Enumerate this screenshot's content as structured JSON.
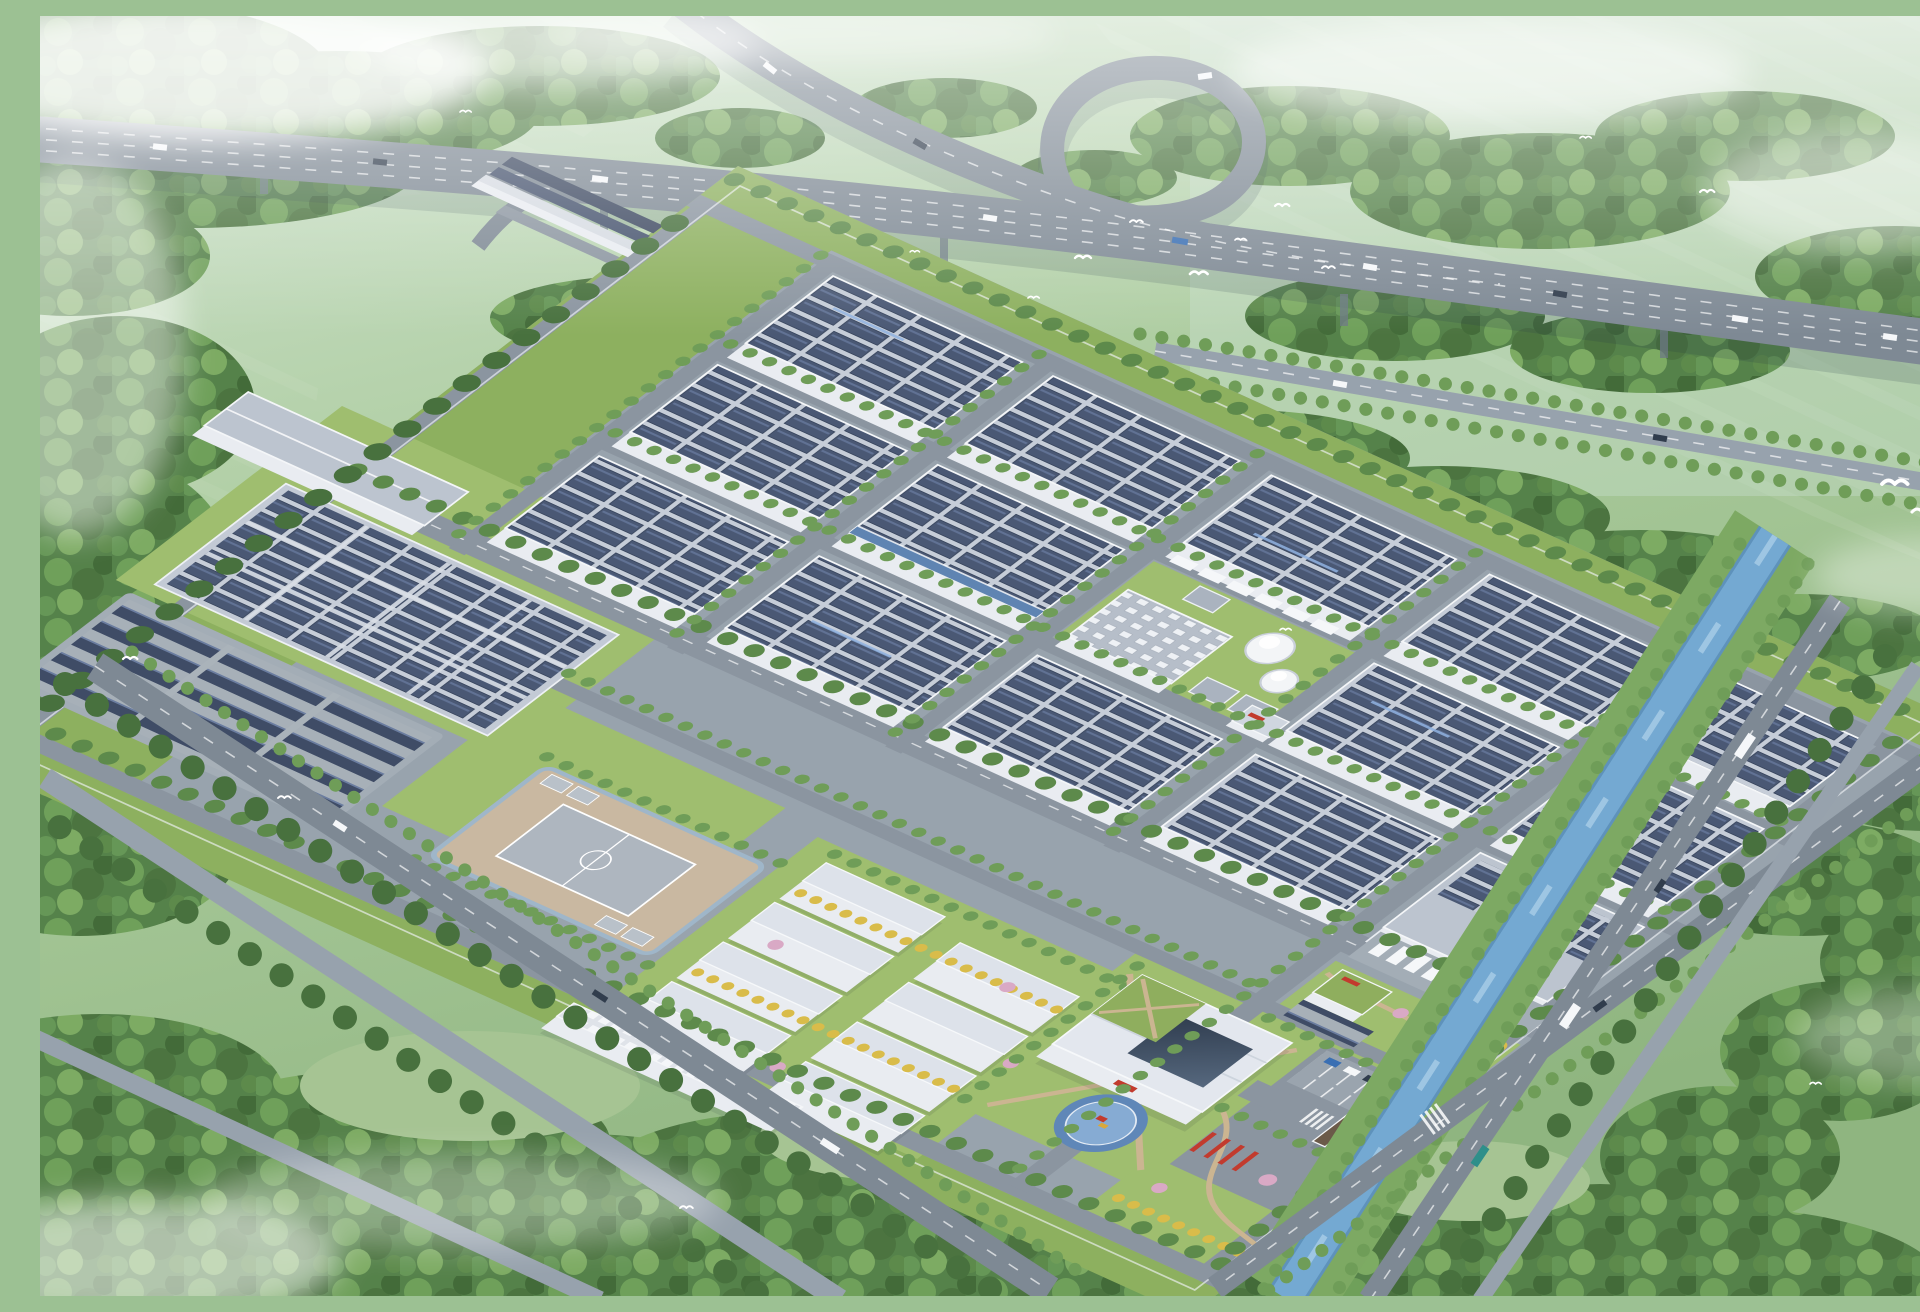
{
  "meta": {
    "title": "Aerial rendering of a solar-roofed factory campus",
    "caption": "Bird's-eye architectural rendering of a large manufacturing campus: rows of white factory halls covered with rooftop solar arrays, a ground solar farm and solar carports, a running-track sports field, white dormitory blocks, a headquarters with a circular blue helipad plaza, a landscaped riverside park with red pergolas, a canal, perimeter boulevards, dense forest belts, misty green farmland and an elevated expressway interchange with traffic and flocks of white birds."
  },
  "scene": {
    "elements": [
      "elevated-expressway-interchange",
      "factory-halls-with-solar-roofs",
      "ground-solar-farm",
      "solar-carport-parking",
      "sports-field",
      "dormitory-blocks",
      "headquarters-building",
      "helipad-plaza",
      "entrance-gate",
      "logistics-dock-with-trailers",
      "storage-tanks",
      "utility-plant",
      "landscaped-park",
      "red-pergolas",
      "canal",
      "perimeter-boulevards",
      "forest-belts",
      "farmland",
      "mist-clouds",
      "white-birds"
    ],
    "counts": {
      "factory_halls": 14,
      "dormitory_blocks": 8,
      "storage_tanks": 2,
      "helipads": 1,
      "sports_fields": 1,
      "entrance_gates": 1,
      "canals": 1,
      "expressway_loops": 1
    }
  },
  "colors": {
    "field_green": "#a9c79b",
    "forest_green": "#55824a",
    "lawn_green": "#9fbe6f",
    "campus_ground": "#98a3ad",
    "highway_deck": "#7e8995",
    "roof_deck": "#c6cdd8",
    "solar_panel": "#4a5874",
    "solar_highlight": "#8fb2e0",
    "carport": "#3f4c66",
    "wall_white": "#e9ecf1",
    "water": "#74a9d2",
    "river_bank": "#7da963",
    "sport_field_tan": "#c9b8a1",
    "sport_pitch": "#aeb6bf",
    "path_tan": "#cbb591",
    "accent_red": "#c23b2e",
    "gingko_yellow": "#d9bc4a",
    "blossom_pink": "#d9a9c5",
    "helipad": "#86abd3",
    "glass": "#46566b",
    "haze_white": "#ffffff"
  }
}
